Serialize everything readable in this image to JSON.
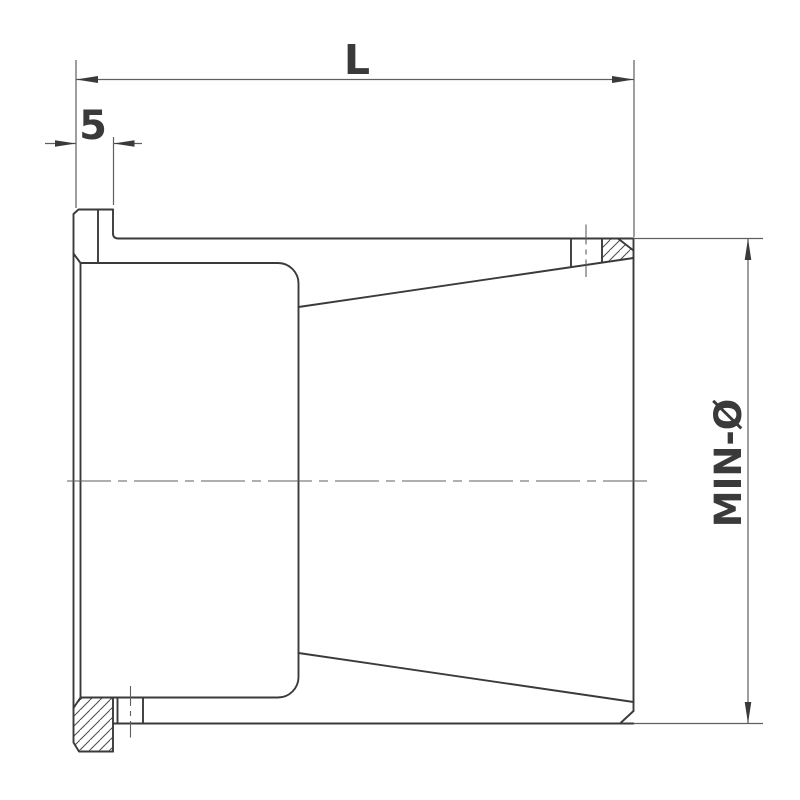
{
  "drawing": {
    "view": "section-side-view",
    "labels": {
      "length": "L",
      "flange_width": "5",
      "min_diameter": "MIN-Ø"
    },
    "colors": {
      "bg": "#ffffff",
      "outline": "#3a3a3a",
      "thin": "#5f5f5f",
      "hatch": "#4a4a4a"
    }
  }
}
